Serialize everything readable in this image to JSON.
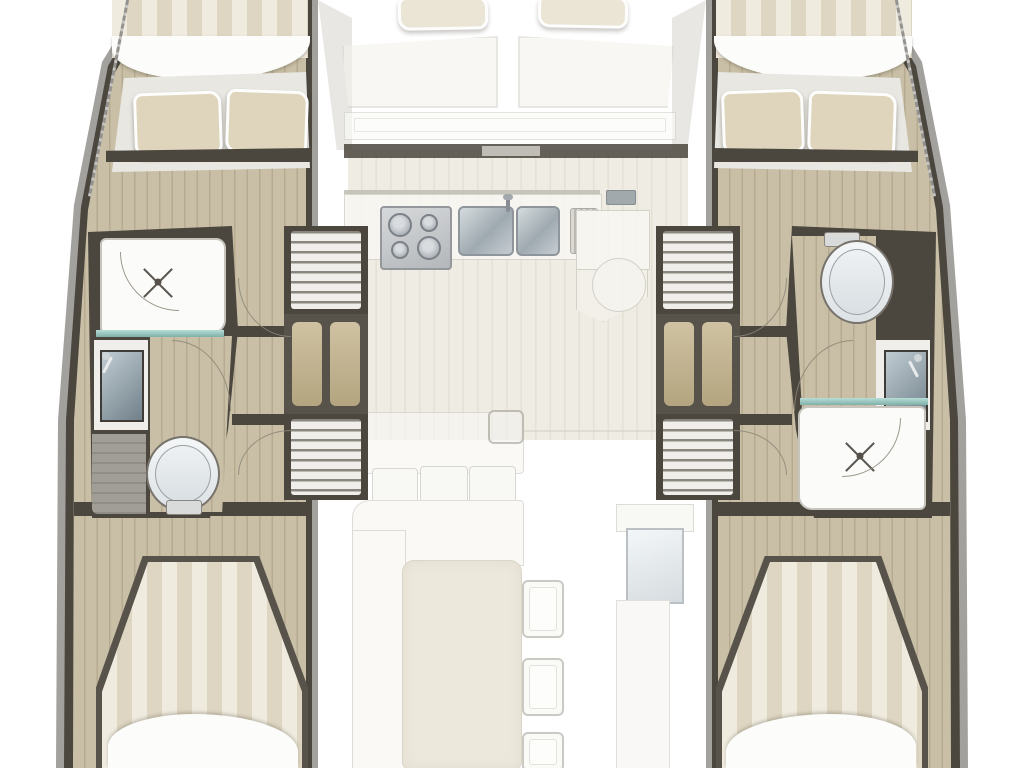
{
  "meta": {
    "title": "Catamaran interior floor plan, top view",
    "canvas_width": 1024,
    "canvas_height": 768,
    "style": "architectural boat layout rendering, no text labels visible"
  },
  "palette": {
    "bg": "#ffffff",
    "hull-band": "#a3a19d",
    "wall": "#4b463e",
    "wood": "#c9bfa6",
    "wood-stripe": "#b6ab90",
    "platform": "#e9e7e2",
    "pillow": "#ded5bc",
    "stripe-light": "#f0ebdf",
    "stripe-dark": "#ded6c2",
    "white-fix": "#fbfbfa",
    "fix-border": "#c8c5bd",
    "metal": "#b7bdc4",
    "glass-teal": "#8fbfb7",
    "floor-pale": "#efece4",
    "floor-pale-stripe": "#e5e1d5",
    "table": "#e4decb",
    "arc": "#8d8779",
    "gray-floor": "#a09e97"
  },
  "legend": {
    "port_hull": {
      "label": "Port hull",
      "areas": [
        "Forward cabin berth with two pillows",
        "Shower room with shower head",
        "Washbasin with mirror",
        "Toilet",
        "Companionway stairs forward",
        "Storage locker",
        "Companionway stairs aft",
        "Aft cabin berth with duvet"
      ]
    },
    "starboard_hull": {
      "label": "Starboard hull",
      "areas": [
        "Forward cabin berth with two pillows",
        "Toilet",
        "Washbasin with mirror",
        "Shower room with shower head",
        "Companionway stairs forward",
        "Storage locker",
        "Companionway stairs aft",
        "Aft cabin berth with duvet"
      ]
    },
    "center": {
      "label": "Bridge deck saloon",
      "areas": [
        "Forward cockpit bench with two back cushions",
        "Entry door wall",
        "Galley counter",
        "Four-burner stove",
        "Double stainless sink with faucet",
        "Drainer rack",
        "Peninsula unit with round seat",
        "Saloon floor",
        "L-shaped sofa with cushions",
        "Dining table",
        "Three chairs",
        "Wet bar cabinet with glass top"
      ]
    }
  }
}
